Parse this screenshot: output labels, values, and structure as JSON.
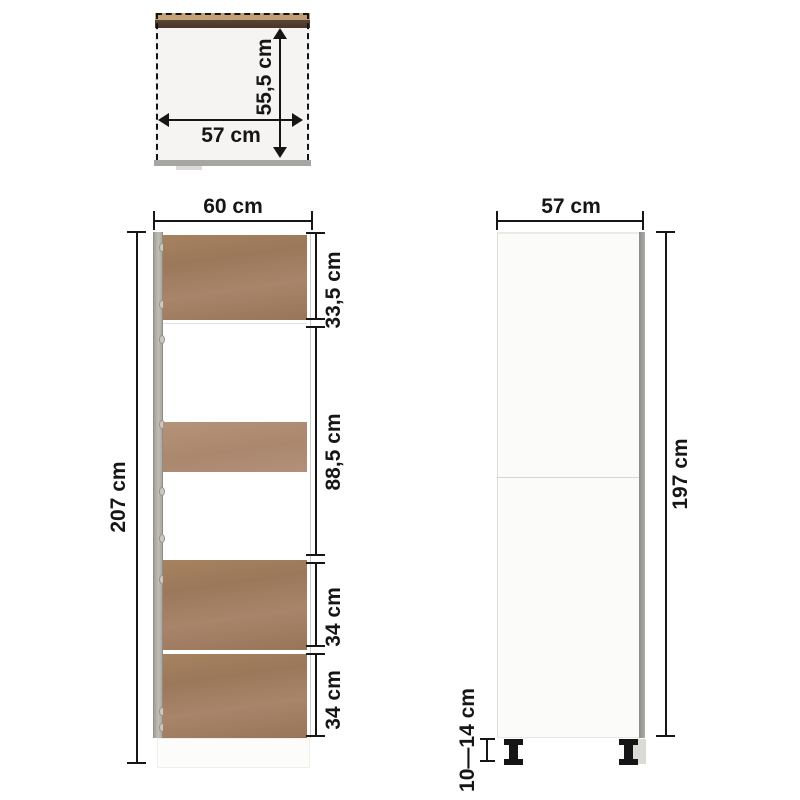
{
  "meta": {
    "description": "Tall kitchen cabinet dimension diagram with top, front and side orthographic views"
  },
  "top_view": {
    "width": "57 cm",
    "depth": "55,5 cm"
  },
  "front_view": {
    "width": "60 cm",
    "height": "207 cm",
    "sections": [
      "33,5 cm",
      "88,5 cm",
      "34 cm",
      "34 cm"
    ]
  },
  "side_view": {
    "depth": "57 cm",
    "height": "197 cm",
    "feet": "10—14 cm"
  },
  "colors": {
    "wood": "#a07c5e",
    "wood_light": "#b2907a",
    "wood_tan": "#c2a077",
    "wood_dark": "#4e3b2c",
    "cabinet_gray": "#b6b3ad",
    "dim_line": "#161616"
  }
}
